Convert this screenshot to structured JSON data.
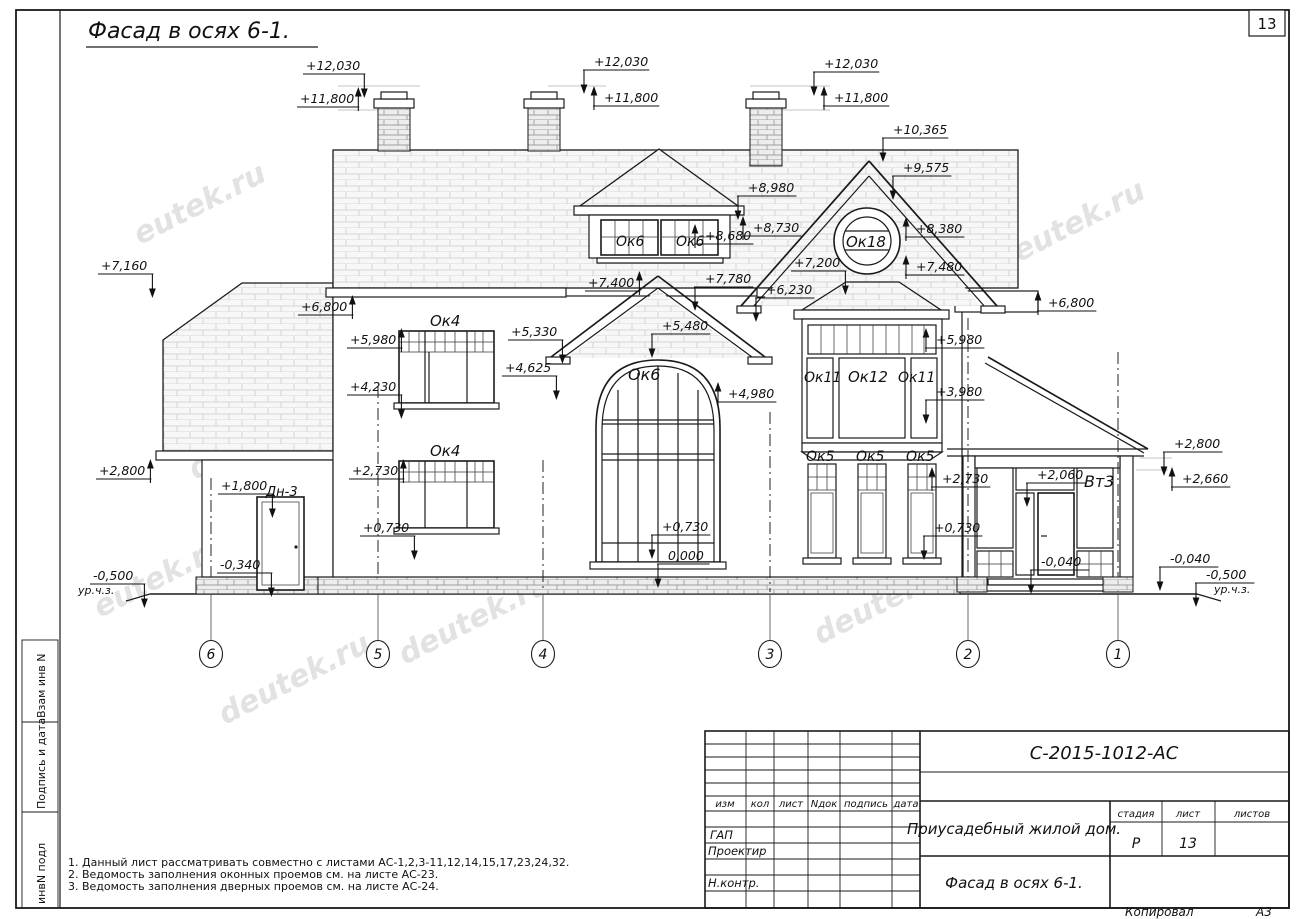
{
  "title": "Фасад в осях 6-1.",
  "page": {
    "sheet_number": "13",
    "copied": "Копировал",
    "format": "А3"
  },
  "side_labels": [
    "Взам инв N",
    "Подпись и дата",
    "инвN подл"
  ],
  "notes": [
    "1. Данный лист рассматривать совместно с листами АС-1,2,3-11,12,14,15,17,23,24,32.",
    "2. Ведомость заполнения оконных проемов см. на листе АС-23.",
    "3. Ведомость заполнения дверных проемов см. на листе АС-24."
  ],
  "title_block": {
    "doc_number": "С-2015-1012-АС",
    "project_name": "Приусадебный жилой дом.",
    "sheet_name": "Фасад в осях 6-1.",
    "cols": {
      "izm": "изм",
      "kol": "кол",
      "list": "лист",
      "ndok": "Nдок",
      "podpis": "подпись",
      "data": "дата"
    },
    "stage_label": "стадия",
    "sheet_label": "лист",
    "sheets_label": "листов",
    "stage": "Р",
    "sheet": "13",
    "roles": {
      "gap": "ГАП",
      "proj": "Проектир",
      "nkontr": "Н.контр."
    }
  },
  "drawing": {
    "marks": [
      {
        "t": "+12,030",
        "x": 306,
        "y": 70,
        "s": "r",
        "d": "dn"
      },
      {
        "t": "+11,800",
        "x": 300,
        "y": 103,
        "s": "r",
        "d": "up"
      },
      {
        "t": "+12,030",
        "x": 594,
        "y": 66,
        "s": "l",
        "d": "dn"
      },
      {
        "t": "+11,800",
        "x": 604,
        "y": 102,
        "s": "l",
        "d": "up"
      },
      {
        "t": "+12,030",
        "x": 824,
        "y": 68,
        "s": "l",
        "d": "dn"
      },
      {
        "t": "+11,800",
        "x": 834,
        "y": 102,
        "s": "l",
        "d": "up"
      },
      {
        "t": "+10,365",
        "x": 893,
        "y": 134,
        "s": "l",
        "d": "dn"
      },
      {
        "t": "+9,575",
        "x": 903,
        "y": 172,
        "s": "l",
        "d": "dn"
      },
      {
        "t": "+8,980",
        "x": 748,
        "y": 192,
        "s": "l",
        "d": "dn"
      },
      {
        "t": "+8,730",
        "x": 753,
        "y": 232,
        "s": "l",
        "d": "up"
      },
      {
        "t": "+8,680",
        "x": 705,
        "y": 240,
        "s": "l",
        "d": "up"
      },
      {
        "t": "+7,780",
        "x": 705,
        "y": 283,
        "s": "l",
        "d": "dn"
      },
      {
        "t": "+7,400",
        "x": 588,
        "y": 287,
        "s": "r",
        "d": "up"
      },
      {
        "t": "+8,380",
        "x": 916,
        "y": 233,
        "s": "l",
        "d": "up"
      },
      {
        "t": "+7,480",
        "x": 916,
        "y": 271,
        "s": "l",
        "d": "up"
      },
      {
        "t": "+7,200",
        "x": 794,
        "y": 267,
        "s": "r",
        "d": "dn"
      },
      {
        "t": "+6,230",
        "x": 766,
        "y": 294,
        "s": "l",
        "d": "dn"
      },
      {
        "t": "+7,160",
        "x": 101,
        "y": 270,
        "s": "r",
        "d": "dn"
      },
      {
        "t": "+6,800",
        "x": 301,
        "y": 311,
        "s": "r",
        "d": "up"
      },
      {
        "t": "+6,800",
        "x": 1048,
        "y": 307,
        "s": "l",
        "d": "up"
      },
      {
        "t": "+5,980",
        "x": 350,
        "y": 344,
        "s": "r",
        "d": "up"
      },
      {
        "t": "+4,230",
        "x": 350,
        "y": 391,
        "s": "r",
        "d": "dn"
      },
      {
        "t": "+5,330",
        "x": 511,
        "y": 336,
        "s": "r",
        "d": "dn"
      },
      {
        "t": "+4,625",
        "x": 505,
        "y": 372,
        "s": "r",
        "d": "dn"
      },
      {
        "t": "+5,480",
        "x": 662,
        "y": 330,
        "s": "l",
        "d": "dn"
      },
      {
        "t": "+4,980",
        "x": 728,
        "y": 398,
        "s": "l",
        "d": "up"
      },
      {
        "t": "+5,980",
        "x": 936,
        "y": 344,
        "s": "l",
        "d": "up"
      },
      {
        "t": "+3,980",
        "x": 936,
        "y": 396,
        "s": "l",
        "d": "dn"
      },
      {
        "t": "+2,800",
        "x": 99,
        "y": 475,
        "s": "r",
        "d": "up"
      },
      {
        "t": "+2,730",
        "x": 352,
        "y": 475,
        "s": "r",
        "d": "up"
      },
      {
        "t": "+1,800",
        "x": 221,
        "y": 490,
        "s": "r",
        "d": "dn"
      },
      {
        "t": "+0,730",
        "x": 363,
        "y": 532,
        "s": "r",
        "d": "dn"
      },
      {
        "t": "+2,730",
        "x": 942,
        "y": 483,
        "s": "l",
        "d": "up"
      },
      {
        "t": "+0,730",
        "x": 934,
        "y": 532,
        "s": "l",
        "d": "dn"
      },
      {
        "t": "+0,730",
        "x": 662,
        "y": 531,
        "s": "l",
        "d": "dn"
      },
      {
        "t": "0,000",
        "x": 668,
        "y": 560,
        "s": "l",
        "d": "dn"
      },
      {
        "t": "+2,060",
        "x": 1037,
        "y": 479,
        "s": "l",
        "d": "dn"
      },
      {
        "t": "-0,040",
        "x": 1041,
        "y": 566,
        "s": "l",
        "d": "dn"
      },
      {
        "t": "-0,340",
        "x": 220,
        "y": 569,
        "s": "r",
        "d": "dn"
      },
      {
        "t": "+2,800",
        "x": 1174,
        "y": 448,
        "s": "l",
        "d": "dn"
      },
      {
        "t": "+2,660",
        "x": 1182,
        "y": 483,
        "s": "l",
        "d": "up"
      },
      {
        "t": "-0,040",
        "x": 1170,
        "y": 563,
        "s": "l",
        "d": "dn"
      },
      {
        "t": "-0,500",
        "x": 93,
        "y": 580,
        "s": "r",
        "d": "dn"
      },
      {
        "t": "-0,500",
        "x": 1206,
        "y": 579,
        "s": "l",
        "d": "dn"
      }
    ],
    "labels": [
      {
        "t": "Ок4",
        "x": 430,
        "y": 326,
        "fs": 15
      },
      {
        "t": "Ок4",
        "x": 430,
        "y": 456,
        "fs": 15
      },
      {
        "t": "Ок6",
        "x": 616,
        "y": 246,
        "fs": 14
      },
      {
        "t": "Ок6",
        "x": 676,
        "y": 246,
        "fs": 14
      },
      {
        "t": "Ок6",
        "x": 628,
        "y": 380,
        "fs": 16
      },
      {
        "t": "Ок18",
        "x": 846,
        "y": 247,
        "fs": 15
      },
      {
        "t": "Ок11",
        "x": 804,
        "y": 382,
        "fs": 14
      },
      {
        "t": "Ок12",
        "x": 848,
        "y": 382,
        "fs": 15
      },
      {
        "t": "Ок11",
        "x": 898,
        "y": 382,
        "fs": 14
      },
      {
        "t": "Ок5",
        "x": 806,
        "y": 461,
        "fs": 14
      },
      {
        "t": "Ок5",
        "x": 856,
        "y": 461,
        "fs": 14
      },
      {
        "t": "Ок5",
        "x": 906,
        "y": 461,
        "fs": 14
      },
      {
        "t": "Вт3",
        "x": 1084,
        "y": 487,
        "fs": 16
      },
      {
        "t": "Дн-3",
        "x": 266,
        "y": 496,
        "fs": 13
      },
      {
        "t": "ур.ч.з.",
        "x": 78,
        "y": 594,
        "fs": 11
      },
      {
        "t": "ур.ч.з.",
        "x": 1214,
        "y": 593,
        "fs": 11
      }
    ],
    "axes": [
      {
        "n": "6",
        "x": 211
      },
      {
        "n": "5",
        "x": 378
      },
      {
        "n": "4",
        "x": 543
      },
      {
        "n": "3",
        "x": 770
      },
      {
        "n": "2",
        "x": 968
      },
      {
        "n": "1",
        "x": 1118
      }
    ],
    "watermarks": [
      {
        "t": "eutek.ru",
        "x": 140,
        "y": 245
      },
      {
        "t": "deutek.ru",
        "x": 195,
        "y": 480
      },
      {
        "t": "deutek.ru",
        "x": 455,
        "y": 545
      },
      {
        "t": "deutek.ru",
        "x": 595,
        "y": 520
      },
      {
        "t": "deutek.ru",
        "x": 405,
        "y": 665
      },
      {
        "t": "deutek.ru",
        "x": 225,
        "y": 725
      },
      {
        "t": "deutek.ru",
        "x": 1000,
        "y": 272
      },
      {
        "t": "deutek.ru",
        "x": 820,
        "y": 645
      },
      {
        "t": "eutek.ru",
        "x": 100,
        "y": 618
      }
    ]
  }
}
